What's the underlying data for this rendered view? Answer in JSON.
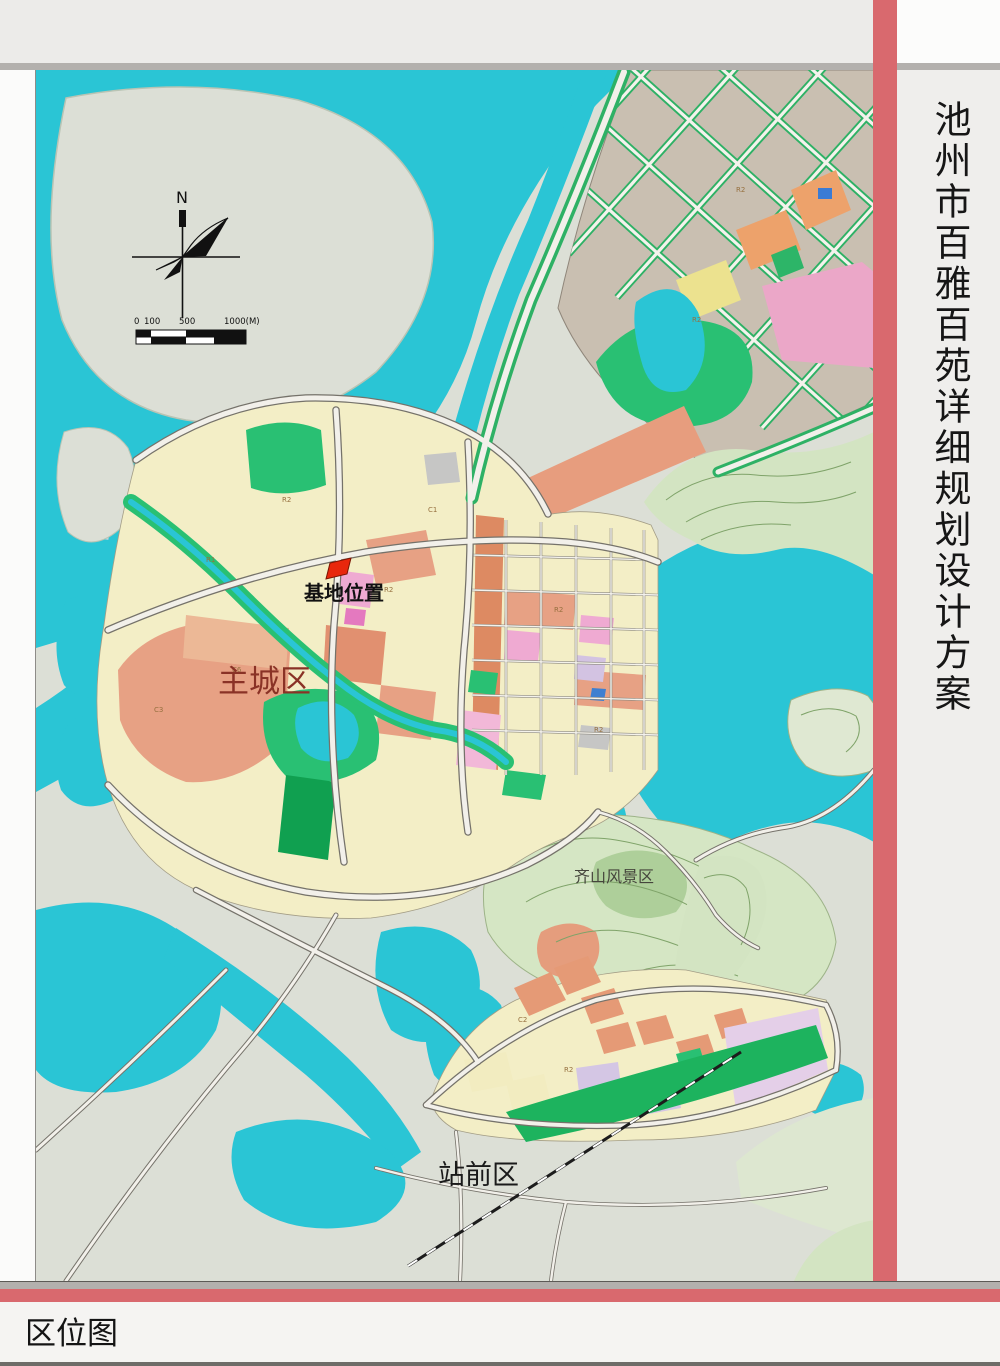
{
  "title_vertical": "池州市百雅百苑详细规划设计方案",
  "caption": "区位图",
  "colors": {
    "accent_red": "#d9696e",
    "water_cyan": "#2ac5d5",
    "land_gray_green": "#dcdfd6",
    "city_yellow": "#f3eec6",
    "park_green": "#29c073",
    "salmon": "#e7a184",
    "ne_district_brown": "#c9bfb1",
    "hill_green": "#d3e4c2",
    "site_marker_red": "#e8270c"
  },
  "map": {
    "labels": {
      "site": "基地位置",
      "main_city": "主城区",
      "scenic": "齐山风景区",
      "station": "站前区"
    },
    "north": "N",
    "scale": [
      "0",
      "100",
      "500",
      "1000(M)"
    ],
    "codes": [
      {
        "t": "R2"
      },
      {
        "t": "R2"
      },
      {
        "t": "R2"
      },
      {
        "t": "R2"
      },
      {
        "t": "C6"
      },
      {
        "t": "C3"
      },
      {
        "t": "R2"
      },
      {
        "t": "R2"
      },
      {
        "t": "C2"
      },
      {
        "t": "R2"
      },
      {
        "t": "R1"
      },
      {
        "t": "C1"
      }
    ]
  }
}
